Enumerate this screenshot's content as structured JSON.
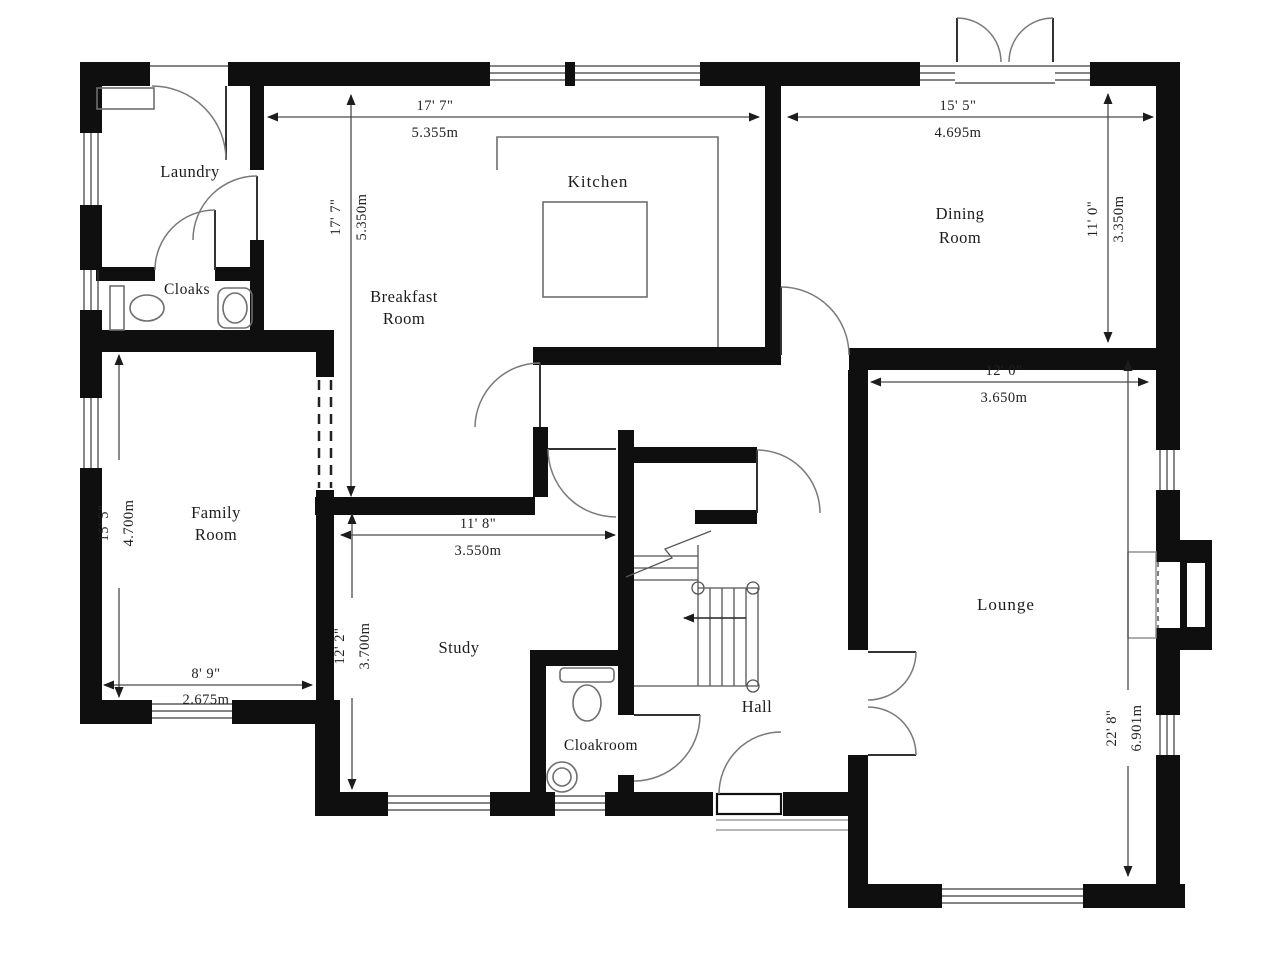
{
  "floor_plan": {
    "colors": {
      "wall": "#0f0f0f",
      "door_line": "#7a7a7a",
      "text": "#1c1c1c",
      "background": "#ffffff"
    },
    "rooms": {
      "laundry": {
        "label": "Laundry"
      },
      "cloaks": {
        "label": "Cloaks"
      },
      "kitchen": {
        "label": "Kitchen"
      },
      "breakfast": {
        "line1": "Breakfast",
        "line2": "Room"
      },
      "dining": {
        "line1": "Dining",
        "line2": "Room"
      },
      "family": {
        "line1": "Family",
        "line2": "Room"
      },
      "study": {
        "label": "Study"
      },
      "hall": {
        "label": "Hall"
      },
      "cloakroom": {
        "label": "Cloakroom"
      },
      "lounge": {
        "label": "Lounge"
      }
    },
    "dimensions": {
      "kitchen_width": {
        "imperial": "17' 7\"",
        "metric": "5.355m"
      },
      "breakfast_depth": {
        "imperial": "17' 7\"",
        "metric": "5.350m"
      },
      "dining_width": {
        "imperial": "15' 5\"",
        "metric": "4.695m"
      },
      "dining_depth": {
        "imperial": "11' 0\"",
        "metric": "3.350m"
      },
      "lounge_width": {
        "imperial": "12' 0\"",
        "metric": "3.650m"
      },
      "lounge_depth": {
        "imperial": "22' 8\"",
        "metric": "6.901m"
      },
      "family_depth": {
        "imperial": "15' 5\"",
        "metric": "4.700m"
      },
      "family_width": {
        "imperial": "8' 9\"",
        "metric": "2.675m"
      },
      "study_width": {
        "imperial": "11' 8\"",
        "metric": "3.550m"
      },
      "study_depth": {
        "imperial": "12' 2\"",
        "metric": "3.700m"
      }
    }
  }
}
